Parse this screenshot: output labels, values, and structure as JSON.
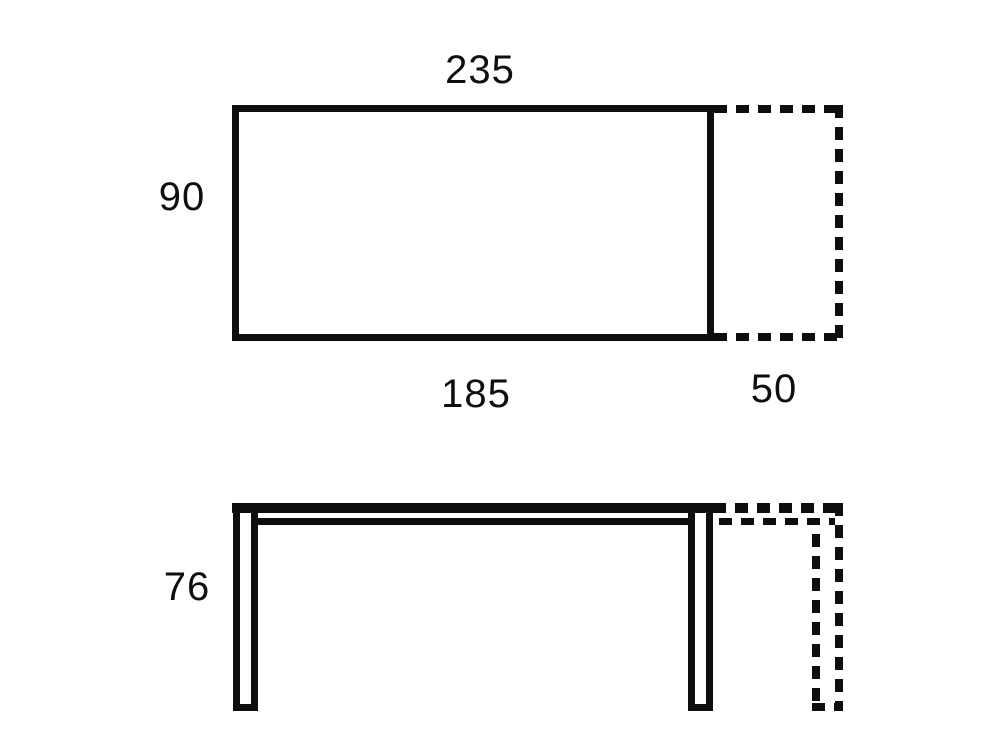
{
  "colors": {
    "ink": "#0e0e0e",
    "background": "#ffffff"
  },
  "top_view": {
    "width_total": "235",
    "depth": "90",
    "width_main": "185",
    "width_extension": "50"
  },
  "side_view": {
    "height": "76"
  }
}
